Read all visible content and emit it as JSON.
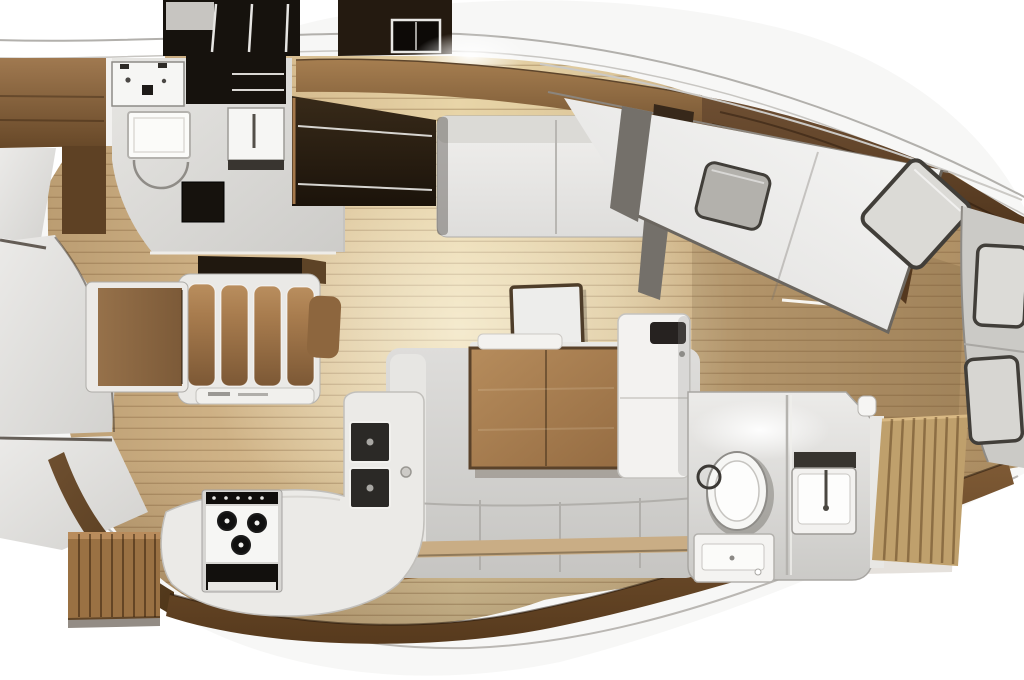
{
  "meta": {
    "title": "sailing-yacht-interior-floor-plan",
    "view": "top-down-cutaway-3d-render",
    "image_width": 1024,
    "image_height": 680,
    "visible_text": "none"
  },
  "palette": {
    "background": "#ffffff",
    "deck_white": "#f7f7f6",
    "sheer_line": "#b2b0ac",
    "floor_tan": "#cfb286",
    "floor_cream": "#e8d5a8",
    "floor_aft": "#aa8c61",
    "plank_line": "#73522e",
    "panel_grey": "#e4e3e0",
    "seam_dark": "#4c443c",
    "locker_black": "#16120d",
    "locker_brown": "#241a10",
    "wood_trim_mid": "#8a6238",
    "wood_dark": "#54381e",
    "slat_wood": "#9a7143",
    "steps_wood": "#bfa06c",
    "counter_white": "#ebeae7",
    "porcelain": "#f6f6f4",
    "sink_dark": "#2b2926",
    "appliance_black": "#12100d",
    "upholstery_white": "#eae9e6",
    "sofa_grey": "#d2d1ce",
    "cushion_brown": "#a87c4e",
    "table_wood": "#a5794c",
    "bulkhead_grey": "#74706a",
    "stern_berth_grey": "#cbcac6",
    "berth_light": "#ebeae7",
    "pillow_grey": "#b3b1ac",
    "pillow_white": "#dbdad6",
    "pillow_edge": "#413e39",
    "front_trim_tan": "#c9ad85"
  },
  "areas": {
    "bow": [
      "sail-locker-panels",
      "hull-side-wood-cabinet"
    ],
    "forward_head": [
      "washbasin-unit",
      "vanity-with-faucet",
      "shower-tray",
      "door-swing-arc",
      "storage-hatch",
      "overhead-lockers"
    ],
    "saloon": [
      "dinette-table",
      "dinette-settee-four-cushions",
      "starboard-settee",
      "coffee-table",
      "saloon-table",
      "c-shaped-sofa",
      "fridge-cabinet",
      "ceiling-light-glow"
    ],
    "galley": [
      "l-shaped-counter",
      "three-burner-stove-with-oven",
      "double-sink",
      "faucet"
    ],
    "aft_head": [
      "toilet",
      "shower-hose-coil",
      "vanity-basin",
      "drawer-unit"
    ],
    "aft_cabins": [
      "diagonal-double-berth",
      "stern-double-berth",
      "pillows",
      "companionway-slats"
    ],
    "finishes": [
      "teak-plank-flooring",
      "mahogany-hull-trims"
    ]
  }
}
